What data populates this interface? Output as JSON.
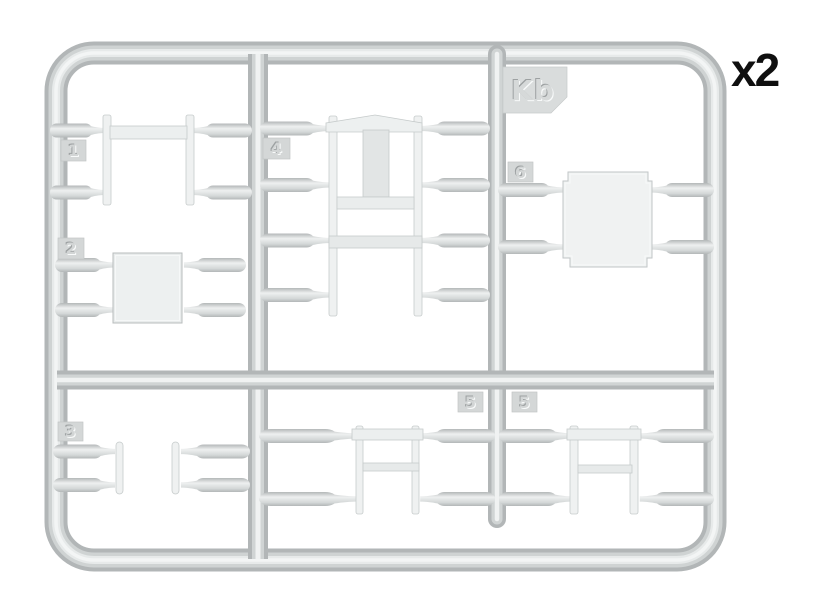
{
  "diagram": {
    "type": "model-kit-sprue-layout",
    "sprue_code": "Kb",
    "quantity_note": "x2",
    "part_numbers": {
      "tag_1": "1",
      "tag_2": "2",
      "tag_3": "3",
      "tag_4": "4",
      "tag_5_left": "5",
      "tag_5_right": "5",
      "tag_6": "6"
    }
  },
  "colors": {
    "background": "#ffffff",
    "plastic_shadow": "#b2b6b7",
    "plastic_mid": "#d0d4d4",
    "plastic_highlight": "#eef0f0",
    "flat_part_fill": "#eff1f1",
    "flat_part_stroke": "#c6cbcb",
    "tag_fill": "#d4d7d7",
    "sprue_code_tag_fill": "#d9dcdc",
    "quantity_text": "#0f0f0f"
  }
}
